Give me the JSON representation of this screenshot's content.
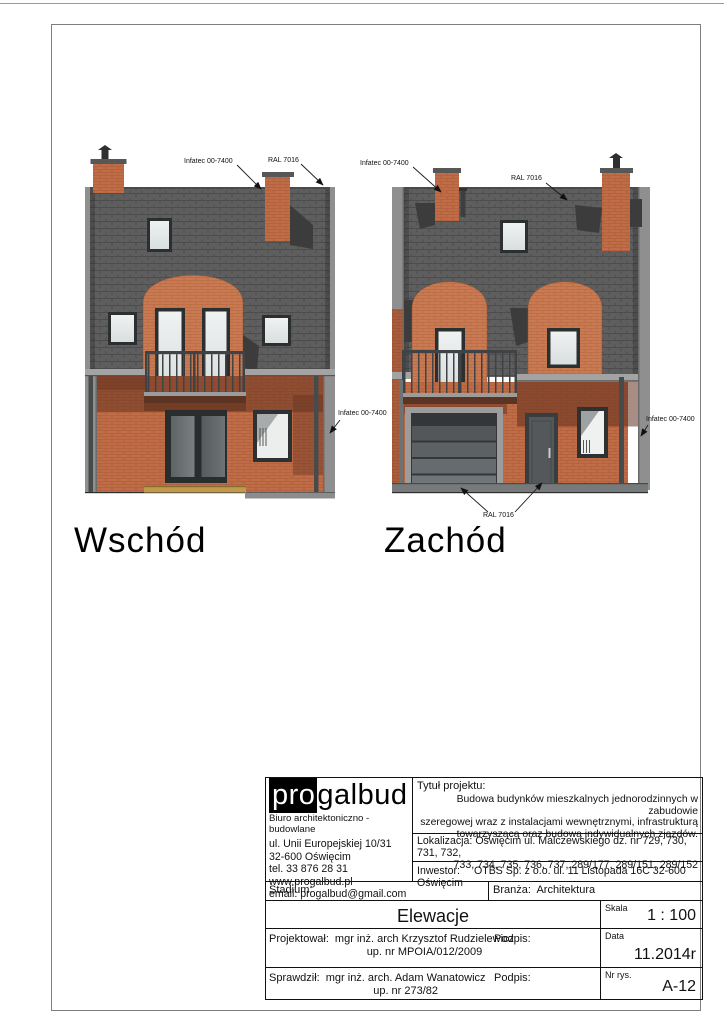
{
  "drawing_labels": {
    "east": "Wschód",
    "west": "Zachód"
  },
  "annotations": {
    "facade_paint": "Infatec 00-7400",
    "ral_color": "RAL 7016"
  },
  "title_block": {
    "company": {
      "logo_pro": "pro",
      "logo_rest": "galbud",
      "subtitle": "Biuro  architektoniczno - budowlane",
      "address_lines": [
        "ul. Unii Europejskiej 10/31",
        "32-600 Oświęcim",
        "tel. 33 876 28 31",
        "www.progalbud.pl",
        "email: progalbud@gmail.com"
      ]
    },
    "project": {
      "label": "Tytuł projektu:",
      "description_lines": [
        "Budowa budynków mieszkalnych jednorodzinnych w zabudowie",
        "szeregowej wraz z instalacjami wewnętrznymi, infrastrukturą",
        "towarzyszącą oraz budową indywidualnych zjazdów."
      ]
    },
    "location": {
      "label": "Lokalizacja:",
      "line1": "Oświęcim ul. Malczewskiego dz. nr 729, 730, 731, 732,",
      "line2": "733, 734, 735, 736, 737, 289/177, 289/151, 289/152"
    },
    "investor": {
      "label": "Inwestor:",
      "value": "OTBS Sp. z o.o. ul. 11 Listopada 16C 32-600 Oświęcim"
    },
    "stadium": {
      "label": "Stadium:"
    },
    "branch": {
      "label": "Branża:",
      "value": "Architektura"
    },
    "drawing_title": "Elewacje",
    "scale": {
      "label": "Skala",
      "value": "1 : 100"
    },
    "designer": {
      "label": "Projektował:",
      "name": "mgr inż. arch Krzysztof Rudzielewicz",
      "license": "up. nr MPOIA/012/2009",
      "signature_label": "Podpis:"
    },
    "checker": {
      "label": "Sprawdził:",
      "name": "mgr inż. arch. Adam Wanatowicz",
      "license": "up. nr 273/82",
      "signature_label": "Podpis:"
    },
    "date": {
      "label": "Data",
      "value": "11.2014r"
    },
    "drawing_no": {
      "label": "Nr rys.",
      "value": "A-12"
    }
  },
  "colors": {
    "brick": "#c06c46",
    "brick_light": "#c97a52",
    "roof": "#5e5e5e",
    "roof_shadow": "#3c3c3c",
    "glass": "#eceeee",
    "frame": "#2e3132",
    "step_yellow": "#bf9a4c"
  }
}
